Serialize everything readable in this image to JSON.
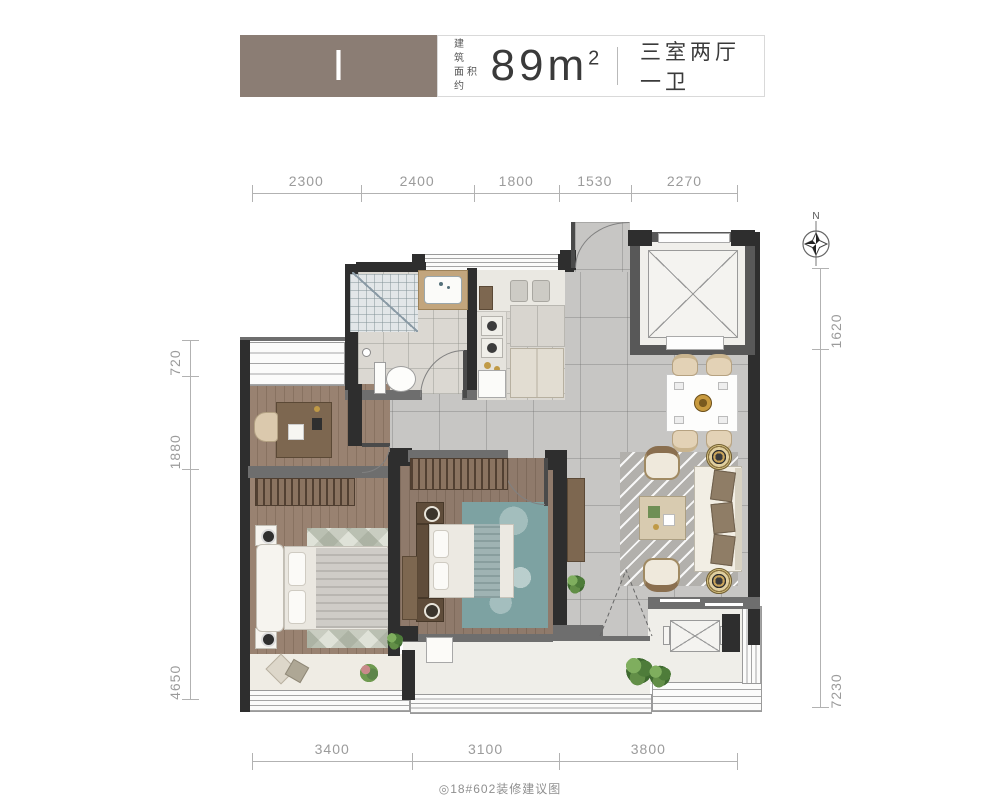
{
  "header": {
    "unit_label": "I",
    "area_label_line1": "建 筑",
    "area_label_line2": "面积约",
    "area_value": "89",
    "area_unit": "m",
    "area_exponent": "2",
    "layout_type": "三室两厅一卫"
  },
  "compass": {
    "north_label": "N"
  },
  "dimensions": {
    "top": [
      "2300",
      "2400",
      "1800",
      "1530",
      "2270"
    ],
    "bottom": [
      "3400",
      "3100",
      "3800"
    ],
    "left": [
      "720",
      "1880",
      "4650"
    ],
    "right": [
      "1620",
      "7230"
    ]
  },
  "caption": "◎18#602装修建议图",
  "colors": {
    "header_block": "#8B7D74",
    "wall_dark": "#2E2E2E",
    "wall_gray": "#6E6E6E",
    "floor_tile": "#C7C6C4",
    "floor_wood": "#998271",
    "accent_teal": "#7DA2A2"
  }
}
